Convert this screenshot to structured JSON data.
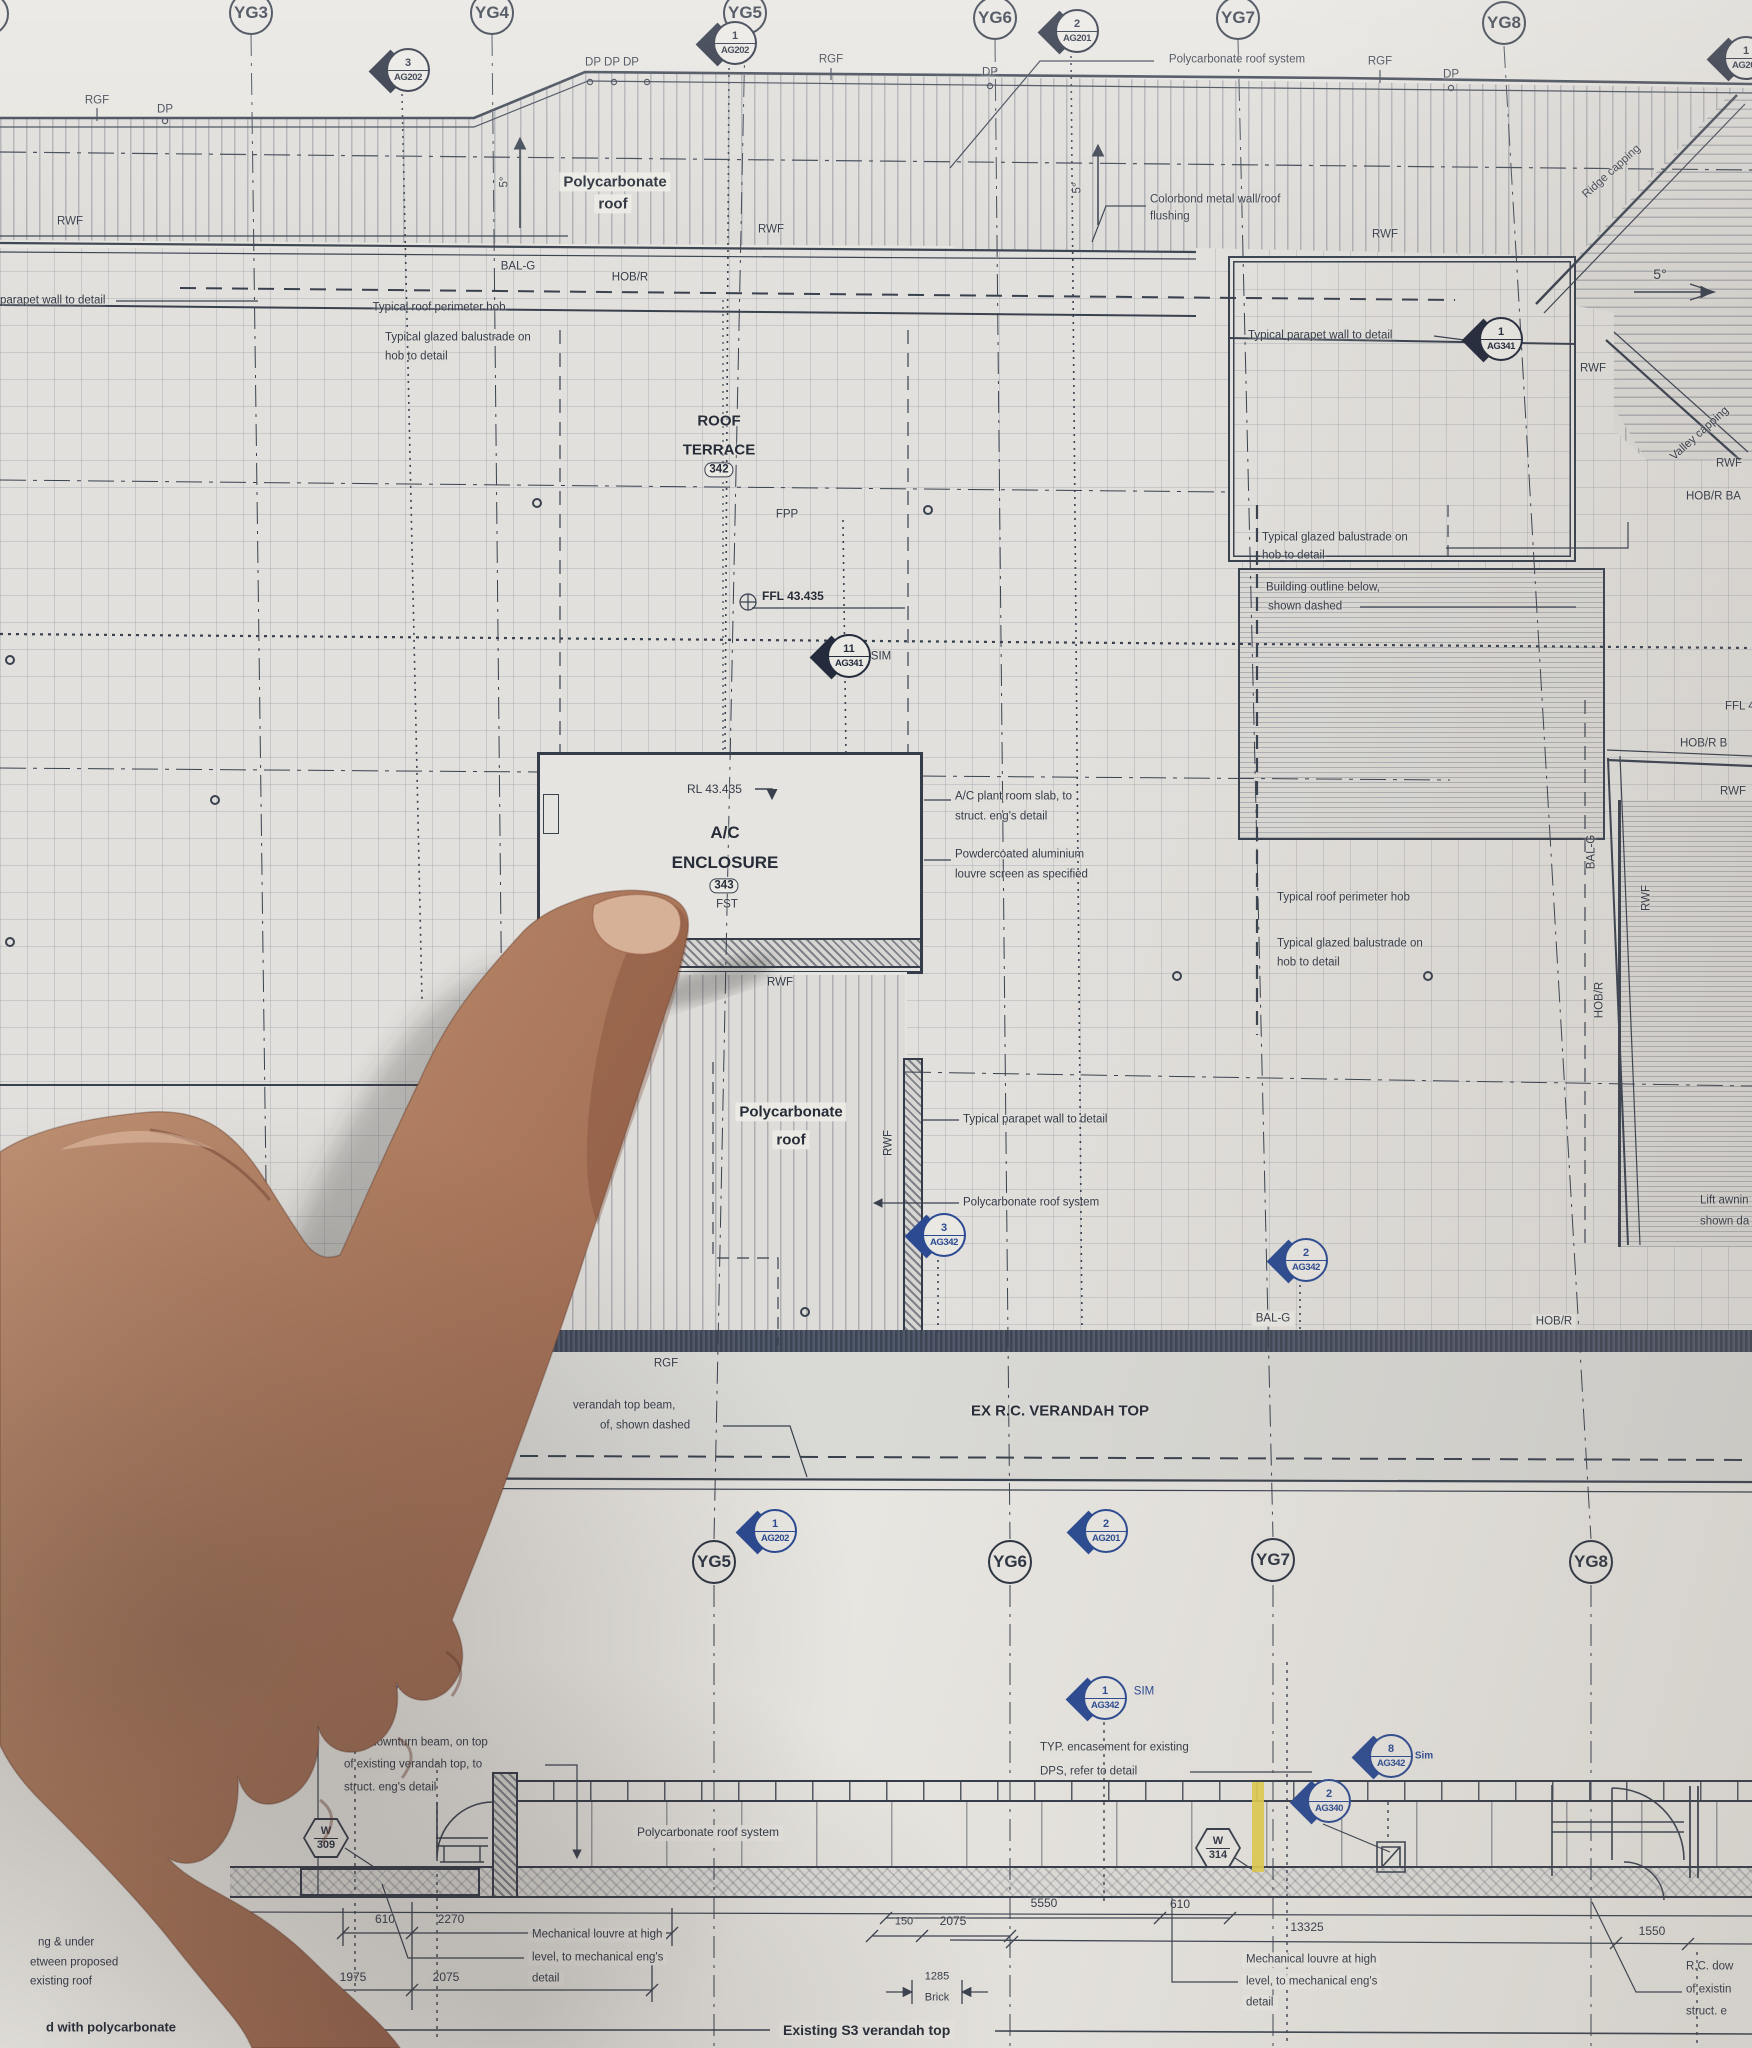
{
  "drawing": {
    "type": "architectural roof plan photo",
    "accent_colors": {
      "ink": "#39414f",
      "pen_blue": "#2b4a92",
      "highlighter_yellow": "#e3cf4e"
    }
  },
  "bubbles": [
    {
      "t": "",
      "x": -13,
      "y": 14
    },
    {
      "t": "YG3",
      "x": 251,
      "y": 13
    },
    {
      "t": "YG4",
      "x": 492,
      "y": 13
    },
    {
      "t": "YG5",
      "x": 745,
      "y": 13
    },
    {
      "t": "YG6",
      "x": 995,
      "y": 18
    },
    {
      "t": "YG7",
      "x": 1238,
      "y": 18
    },
    {
      "t": "YG8",
      "x": 1504,
      "y": 23
    },
    {
      "t": "YG5",
      "x": 714,
      "y": 1562
    },
    {
      "t": "YG6",
      "x": 1010,
      "y": 1562
    },
    {
      "t": "YG7",
      "x": 1273,
      "y": 1560
    },
    {
      "t": "YG8",
      "x": 1591,
      "y": 1562
    }
  ],
  "markers": [
    {
      "n": "3",
      "c": "AG202",
      "x": 402,
      "y": 72,
      "k": "d"
    },
    {
      "n": "1",
      "c": "AG202",
      "x": 729,
      "y": 45,
      "k": "d"
    },
    {
      "n": "2",
      "c": "AG201",
      "x": 1071,
      "y": 33,
      "k": "d"
    },
    {
      "n": "1",
      "c": "AG201",
      "x": 1740,
      "y": 60,
      "k": "d"
    },
    {
      "n": "1",
      "c": "AG341",
      "x": 1495,
      "y": 341,
      "k": "d"
    },
    {
      "n": "11",
      "c": "AG341",
      "x": 843,
      "y": 658,
      "k": "d"
    },
    {
      "n": "3",
      "c": "AG342",
      "x": 938,
      "y": 1237,
      "k": "b"
    },
    {
      "n": "2",
      "c": "AG342",
      "x": 1300,
      "y": 1262,
      "k": "b"
    },
    {
      "n": "1",
      "c": "AG202",
      "x": 769,
      "y": 1533,
      "k": "b"
    },
    {
      "n": "2",
      "c": "AG201",
      "x": 1100,
      "y": 1533,
      "k": "b"
    },
    {
      "n": "",
      "c": "AG342",
      "x": 352,
      "y": 1706,
      "k": "b"
    },
    {
      "n": "1",
      "c": "AG342",
      "x": 1099,
      "y": 1700,
      "k": "b"
    },
    {
      "n": "8",
      "c": "AG342",
      "x": 1385,
      "y": 1758,
      "k": "b"
    },
    {
      "n": "2",
      "c": "AG340",
      "x": 1323,
      "y": 1803,
      "k": "b"
    }
  ],
  "hexes": [
    {
      "top": "W",
      "bot": "309",
      "x": 326,
      "y": 1838
    },
    {
      "top": "W",
      "bot": "314",
      "x": 1218,
      "y": 1848
    }
  ],
  "texts": [
    {
      "t": "RGF",
      "x": 97,
      "y": 101
    },
    {
      "t": "DP",
      "x": 165,
      "y": 110
    },
    {
      "t": "DP DP  DP",
      "x": 612,
      "y": 63
    },
    {
      "t": "RGF",
      "x": 831,
      "y": 60
    },
    {
      "t": "DP",
      "x": 990,
      "y": 73
    },
    {
      "t": "Polycarbonate roof system",
      "x": 1237,
      "y": 60
    },
    {
      "t": "RGF",
      "x": 1380,
      "y": 62
    },
    {
      "t": "DP",
      "x": 1451,
      "y": 75
    },
    {
      "t": "Ridge capping",
      "x": 1612,
      "y": 172,
      "r": -42
    },
    {
      "t": "RWF",
      "x": 70,
      "y": 222
    },
    {
      "t": "RWF",
      "x": 771,
      "y": 230
    },
    {
      "t": "5°",
      "x": 505,
      "y": 182,
      "r": -90
    },
    {
      "t": "Polycarbonate",
      "x": 615,
      "y": 182,
      "s": 15,
      "b": 1,
      "bg": 1,
      "n": "label-polycarbonate-roof"
    },
    {
      "t": "roof",
      "x": 613,
      "y": 204,
      "s": 15,
      "b": 1,
      "bg": 1
    },
    {
      "t": "Colorbond metal wall/roof",
      "x": 1150,
      "y": 200,
      "a": "l"
    },
    {
      "t": "flushing",
      "x": 1150,
      "y": 217,
      "a": "l"
    },
    {
      "t": "5°",
      "x": 1078,
      "y": 188,
      "r": -90
    },
    {
      "t": "BAL-G",
      "x": 518,
      "y": 267
    },
    {
      "t": "HOB/R",
      "x": 630,
      "y": 278
    },
    {
      "t": "parapet wall to detail",
      "x": 0,
      "y": 301,
      "a": "l"
    },
    {
      "t": "Typical roof perimeter hob",
      "x": 439,
      "y": 308
    },
    {
      "t": "Typical glazed balustrade on",
      "x": 385,
      "y": 338,
      "a": "l"
    },
    {
      "t": "hob to detail",
      "x": 385,
      "y": 357,
      "a": "l"
    },
    {
      "t": "Typical parapet wall to detail",
      "x": 1248,
      "y": 336,
      "a": "l"
    },
    {
      "t": "RWF",
      "x": 1385,
      "y": 235
    },
    {
      "t": "5°",
      "x": 1660,
      "y": 274,
      "s": 14
    },
    {
      "t": "RWF",
      "x": 1593,
      "y": 369
    },
    {
      "t": "Valley capping",
      "x": 1700,
      "y": 434,
      "r": -42
    },
    {
      "t": "RWF",
      "x": 1729,
      "y": 464
    },
    {
      "t": "HOB/R  BA",
      "x": 1686,
      "y": 497,
      "a": "l"
    },
    {
      "t": "ROOF",
      "x": 719,
      "y": 421,
      "s": 15,
      "b": 1,
      "n": "room-title-roof-terrace"
    },
    {
      "t": "TERRACE",
      "x": 719,
      "y": 450,
      "s": 15,
      "b": 1
    },
    {
      "t": "342",
      "x": 719,
      "y": 470,
      "box": 1
    },
    {
      "t": "FPP",
      "x": 787,
      "y": 515
    },
    {
      "t": "FFL 43.435",
      "x": 762,
      "y": 597,
      "a": "l",
      "s": 12,
      "b": 1
    },
    {
      "t": "SIM",
      "x": 881,
      "y": 657
    },
    {
      "t": "Typical glazed balustrade on",
      "x": 1262,
      "y": 538,
      "a": "l"
    },
    {
      "t": "hob to detail",
      "x": 1262,
      "y": 556,
      "a": "l"
    },
    {
      "t": "Building outline below,",
      "x": 1266,
      "y": 588,
      "a": "l"
    },
    {
      "t": "shown dashed",
      "x": 1268,
      "y": 607,
      "a": "l"
    },
    {
      "t": "FFL 4",
      "x": 1725,
      "y": 707,
      "a": "l"
    },
    {
      "t": "HOB/R    B",
      "x": 1680,
      "y": 744,
      "a": "l"
    },
    {
      "t": "RWF",
      "x": 1720,
      "y": 792,
      "a": "l"
    },
    {
      "t": "BAL-G",
      "x": 1592,
      "y": 852,
      "r": -90
    },
    {
      "t": "RWF",
      "x": 1647,
      "y": 898,
      "r": -90
    },
    {
      "t": "HOB/R",
      "x": 1600,
      "y": 1000,
      "r": -90
    },
    {
      "t": "RL 43.435",
      "x": 687,
      "y": 790,
      "a": "l",
      "s": 12
    },
    {
      "t": "A/C",
      "x": 725,
      "y": 833,
      "s": 17,
      "b": 1,
      "n": "room-title-ac-enclosure"
    },
    {
      "t": "ENCLOSURE",
      "x": 725,
      "y": 863,
      "s": 17,
      "b": 1
    },
    {
      "t": "343",
      "x": 724,
      "y": 886,
      "box": 1
    },
    {
      "t": "FST",
      "x": 727,
      "y": 905
    },
    {
      "t": "A/C plant room slab,  to",
      "x": 955,
      "y": 797,
      "a": "l"
    },
    {
      "t": "struct. eng's detail",
      "x": 955,
      "y": 817,
      "a": "l"
    },
    {
      "t": "Powdercoated aluminium",
      "x": 955,
      "y": 855,
      "a": "l"
    },
    {
      "t": "louvre screen as specified",
      "x": 955,
      "y": 875,
      "a": "l"
    },
    {
      "t": "Typical roof perimeter hob",
      "x": 1277,
      "y": 898,
      "a": "l"
    },
    {
      "t": "Typical glazed balustrade on",
      "x": 1277,
      "y": 944,
      "a": "l"
    },
    {
      "t": "hob to detail",
      "x": 1277,
      "y": 963,
      "a": "l"
    },
    {
      "t": "RWF",
      "x": 780,
      "y": 983
    },
    {
      "t": "Polycarbonate",
      "x": 791,
      "y": 1112,
      "s": 15,
      "b": 1,
      "bg": 1
    },
    {
      "t": "roof",
      "x": 791,
      "y": 1140,
      "s": 15,
      "b": 1,
      "bg": 1
    },
    {
      "t": "RWF",
      "x": 889,
      "y": 1143,
      "r": -90
    },
    {
      "t": "Typical parapet wall to detail",
      "x": 963,
      "y": 1120,
      "a": "l"
    },
    {
      "t": "Polycarbonate roof system",
      "x": 963,
      "y": 1203,
      "a": "l"
    },
    {
      "t": "Lift awnin",
      "x": 1700,
      "y": 1201,
      "a": "l"
    },
    {
      "t": "shown da",
      "x": 1700,
      "y": 1222,
      "a": "l"
    },
    {
      "t": "BAL-G",
      "x": 1273,
      "y": 1319,
      "bg": 1
    },
    {
      "t": "HOB/R",
      "x": 1554,
      "y": 1322,
      "bg": 1
    },
    {
      "t": "RGF",
      "x": 666,
      "y": 1364
    },
    {
      "t": "verandah top beam,",
      "x": 573,
      "y": 1406,
      "a": "l"
    },
    {
      "t": "of, shown dashed",
      "x": 600,
      "y": 1426,
      "a": "l"
    },
    {
      "t": "EX R.C. VERANDAH TOP",
      "x": 1060,
      "y": 1411,
      "s": 15,
      "b": 1,
      "n": "title-ex-rc-verandah-top"
    },
    {
      "t": "SIM",
      "x": 401,
      "y": 1687,
      "c": "blue"
    },
    {
      "t": "R.C. downturn beam, on top",
      "x": 344,
      "y": 1743,
      "a": "l"
    },
    {
      "t": "of existing verandah top, to",
      "x": 344,
      "y": 1765,
      "a": "l"
    },
    {
      "t": "struct. eng's detail",
      "x": 344,
      "y": 1788,
      "a": "l"
    },
    {
      "t": "Polycarbonate roof system",
      "x": 708,
      "y": 1833,
      "s": 12,
      "bg": 1
    },
    {
      "t": "TYP. encasement for existing",
      "x": 1040,
      "y": 1748,
      "a": "l"
    },
    {
      "t": "DPS, refer to detail",
      "x": 1040,
      "y": 1772,
      "a": "l"
    },
    {
      "t": "SIM",
      "x": 1144,
      "y": 1692,
      "c": "blue"
    },
    {
      "t": "Sim",
      "x": 1424,
      "y": 1756,
      "s": 10,
      "b": 1,
      "c": "blue"
    },
    {
      "t": "Mechanical louvre at high",
      "x": 528,
      "y": 1935,
      "a": "l",
      "bg": 1
    },
    {
      "t": "level, to mechanical eng's",
      "x": 528,
      "y": 1958,
      "a": "l",
      "bg": 1
    },
    {
      "t": "detail",
      "x": 528,
      "y": 1979,
      "a": "l",
      "bg": 1
    },
    {
      "t": "Mechanical louvre at high",
      "x": 1242,
      "y": 1960,
      "a": "l",
      "bg": 1
    },
    {
      "t": "level, to mechanical eng's",
      "x": 1242,
      "y": 1982,
      "a": "l",
      "bg": 1
    },
    {
      "t": "detail",
      "x": 1242,
      "y": 2003,
      "a": "l",
      "bg": 1
    },
    {
      "t": "R.C. dow",
      "x": 1686,
      "y": 1967,
      "a": "l"
    },
    {
      "t": "of existin",
      "x": 1686,
      "y": 1990,
      "a": "l"
    },
    {
      "t": "struct. e",
      "x": 1686,
      "y": 2012,
      "a": "l"
    },
    {
      "t": "610",
      "x": 385,
      "y": 1920,
      "s": 12
    },
    {
      "t": "2270",
      "x": 451,
      "y": 1920,
      "s": 12
    },
    {
      "t": "1975",
      "x": 353,
      "y": 1978,
      "s": 12
    },
    {
      "t": "2075",
      "x": 446,
      "y": 1978,
      "s": 12
    },
    {
      "t": "150",
      "x": 904,
      "y": 1922,
      "s": 11
    },
    {
      "t": "2075",
      "x": 953,
      "y": 1922,
      "s": 12
    },
    {
      "t": "5550",
      "x": 1044,
      "y": 1904,
      "s": 12
    },
    {
      "t": "610",
      "x": 1180,
      "y": 1905,
      "s": 12
    },
    {
      "t": "1285",
      "x": 937,
      "y": 1977,
      "s": 11
    },
    {
      "t": "Brick",
      "x": 937,
      "y": 1998,
      "s": 11
    },
    {
      "t": "13325",
      "x": 1307,
      "y": 1928,
      "s": 12
    },
    {
      "t": "1550",
      "x": 1652,
      "y": 1932,
      "s": 12
    },
    {
      "t": "ng & under",
      "x": 38,
      "y": 1943,
      "a": "l"
    },
    {
      "t": "etween proposed",
      "x": 30,
      "y": 1963,
      "a": "l"
    },
    {
      "t": "existing roof",
      "x": 30,
      "y": 1982,
      "a": "l"
    },
    {
      "t": "d with polycarbonate",
      "x": 46,
      "y": 2028,
      "a": "l",
      "b": 1,
      "s": 13
    },
    {
      "t": "Existing S3 verandah top",
      "x": 779,
      "y": 2030,
      "a": "l",
      "b": 1,
      "s": 14,
      "bg": 1,
      "n": "title-existing-s3-verandah-top"
    }
  ]
}
